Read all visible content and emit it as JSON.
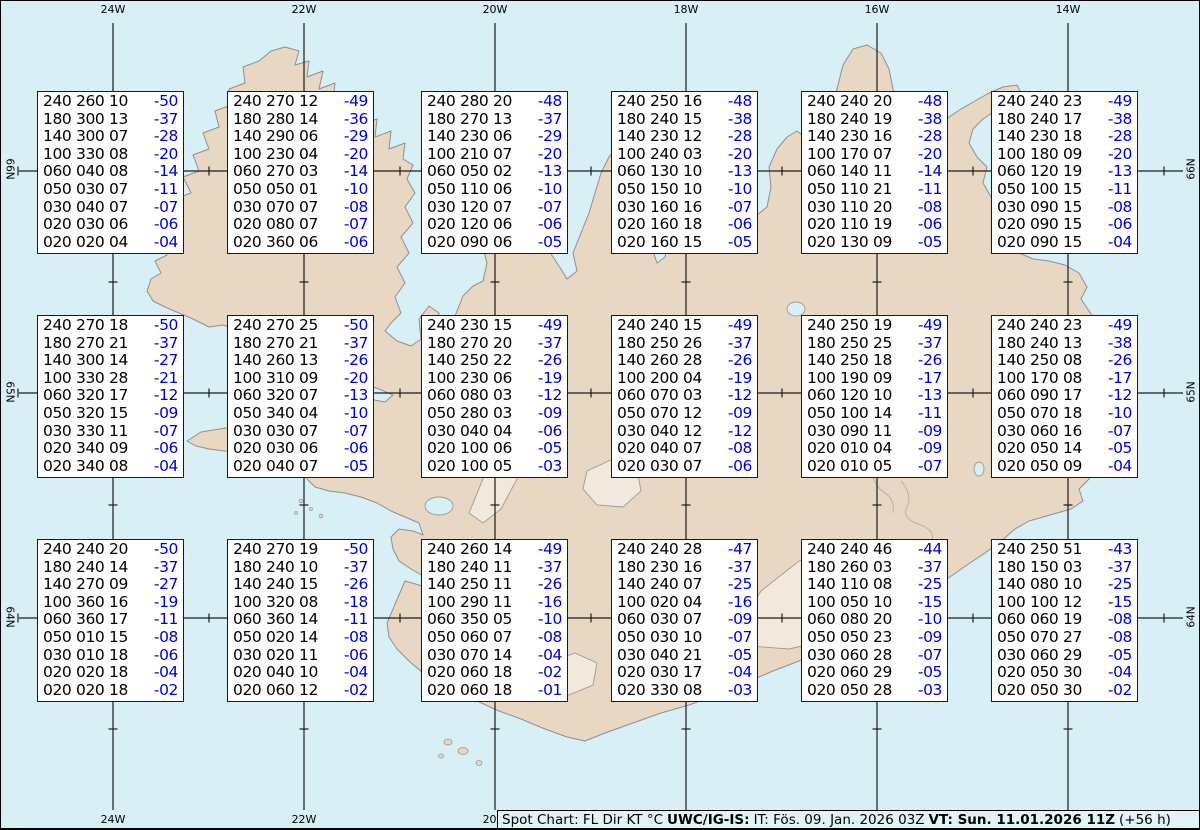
{
  "colors": {
    "ocean": "#d8eff5",
    "land": "#e8d7c2",
    "coastline": "#8f8f8f",
    "graticule": "#1c1c1c",
    "box_background": "#ffffff",
    "value_text": "#000000",
    "temperature_text": "#0000cc",
    "infobar_background": "#e0f5f8"
  },
  "graticule": {
    "top_labels": [
      "24W",
      "22W",
      "20W",
      "18W",
      "16W",
      "14W"
    ],
    "bottom_labels": [
      "24W",
      "22W",
      "20W"
    ],
    "left_labels": [
      "66N",
      "65N",
      "64N"
    ],
    "right_labels": [
      "66N",
      "65N",
      "64N"
    ]
  },
  "status_bar": {
    "title": "Spot Chart: FL Dir KT °C",
    "source": "UWC/IG-IS:",
    "issue": "IT: Fös. 09. Jan. 2026 03Z",
    "valid": "VT: Sun. 11.01.2026 11Z",
    "offset": "(+56 h)"
  },
  "columns": [
    "FL",
    "Dir",
    "KT",
    "°C"
  ],
  "spot_boxes": [
    {
      "rows": [
        [
          "240",
          "260",
          "10",
          "-50"
        ],
        [
          "180",
          "300",
          "13",
          "-37"
        ],
        [
          "140",
          "300",
          "07",
          "-28"
        ],
        [
          "100",
          "330",
          "08",
          "-20"
        ],
        [
          "060",
          "040",
          "08",
          "-14"
        ],
        [
          "050",
          "030",
          "07",
          "-11"
        ],
        [
          "030",
          "040",
          "07",
          "-07"
        ],
        [
          "020",
          "030",
          "06",
          "-06"
        ],
        [
          "020",
          "020",
          "04",
          "-04"
        ]
      ]
    },
    {
      "rows": [
        [
          "240",
          "270",
          "12",
          "-49"
        ],
        [
          "180",
          "280",
          "14",
          "-36"
        ],
        [
          "140",
          "290",
          "06",
          "-29"
        ],
        [
          "100",
          "230",
          "04",
          "-20"
        ],
        [
          "060",
          "270",
          "03",
          "-14"
        ],
        [
          "050",
          "050",
          "01",
          "-10"
        ],
        [
          "030",
          "070",
          "07",
          "-08"
        ],
        [
          "020",
          "080",
          "07",
          "-07"
        ],
        [
          "020",
          "360",
          "06",
          "-06"
        ]
      ]
    },
    {
      "rows": [
        [
          "240",
          "280",
          "20",
          "-48"
        ],
        [
          "180",
          "270",
          "13",
          "-37"
        ],
        [
          "140",
          "230",
          "06",
          "-29"
        ],
        [
          "100",
          "210",
          "07",
          "-20"
        ],
        [
          "060",
          "050",
          "02",
          "-13"
        ],
        [
          "050",
          "110",
          "06",
          "-10"
        ],
        [
          "030",
          "120",
          "07",
          "-07"
        ],
        [
          "020",
          "120",
          "06",
          "-06"
        ],
        [
          "020",
          "090",
          "06",
          "-05"
        ]
      ]
    },
    {
      "rows": [
        [
          "240",
          "250",
          "16",
          "-48"
        ],
        [
          "180",
          "240",
          "15",
          "-38"
        ],
        [
          "140",
          "230",
          "12",
          "-28"
        ],
        [
          "100",
          "240",
          "03",
          "-20"
        ],
        [
          "060",
          "130",
          "10",
          "-13"
        ],
        [
          "050",
          "150",
          "10",
          "-10"
        ],
        [
          "030",
          "160",
          "16",
          "-07"
        ],
        [
          "020",
          "160",
          "18",
          "-06"
        ],
        [
          "020",
          "160",
          "15",
          "-05"
        ]
      ]
    },
    {
      "rows": [
        [
          "240",
          "240",
          "20",
          "-48"
        ],
        [
          "180",
          "240",
          "19",
          "-38"
        ],
        [
          "140",
          "230",
          "16",
          "-28"
        ],
        [
          "100",
          "170",
          "07",
          "-20"
        ],
        [
          "060",
          "140",
          "11",
          "-14"
        ],
        [
          "050",
          "110",
          "21",
          "-11"
        ],
        [
          "030",
          "110",
          "20",
          "-08"
        ],
        [
          "020",
          "110",
          "19",
          "-06"
        ],
        [
          "020",
          "130",
          "09",
          "-05"
        ]
      ]
    },
    {
      "rows": [
        [
          "240",
          "240",
          "23",
          "-49"
        ],
        [
          "180",
          "240",
          "17",
          "-38"
        ],
        [
          "140",
          "230",
          "18",
          "-28"
        ],
        [
          "100",
          "180",
          "09",
          "-20"
        ],
        [
          "060",
          "120",
          "19",
          "-13"
        ],
        [
          "050",
          "100",
          "15",
          "-11"
        ],
        [
          "030",
          "090",
          "15",
          "-08"
        ],
        [
          "020",
          "090",
          "15",
          "-06"
        ],
        [
          "020",
          "090",
          "15",
          "-04"
        ]
      ]
    },
    {
      "rows": [
        [
          "240",
          "270",
          "18",
          "-50"
        ],
        [
          "180",
          "270",
          "21",
          "-37"
        ],
        [
          "140",
          "300",
          "14",
          "-27"
        ],
        [
          "100",
          "330",
          "28",
          "-21"
        ],
        [
          "060",
          "320",
          "17",
          "-12"
        ],
        [
          "050",
          "320",
          "15",
          "-09"
        ],
        [
          "030",
          "330",
          "11",
          "-07"
        ],
        [
          "020",
          "340",
          "09",
          "-06"
        ],
        [
          "020",
          "340",
          "08",
          "-04"
        ]
      ]
    },
    {
      "rows": [
        [
          "240",
          "270",
          "25",
          "-50"
        ],
        [
          "180",
          "270",
          "21",
          "-37"
        ],
        [
          "140",
          "260",
          "13",
          "-26"
        ],
        [
          "100",
          "310",
          "09",
          "-20"
        ],
        [
          "060",
          "320",
          "07",
          "-13"
        ],
        [
          "050",
          "340",
          "04",
          "-10"
        ],
        [
          "030",
          "030",
          "07",
          "-07"
        ],
        [
          "020",
          "030",
          "06",
          "-06"
        ],
        [
          "020",
          "040",
          "07",
          "-05"
        ]
      ]
    },
    {
      "rows": [
        [
          "240",
          "230",
          "15",
          "-49"
        ],
        [
          "180",
          "270",
          "20",
          "-37"
        ],
        [
          "140",
          "250",
          "22",
          "-26"
        ],
        [
          "100",
          "230",
          "06",
          "-19"
        ],
        [
          "060",
          "080",
          "03",
          "-12"
        ],
        [
          "050",
          "280",
          "03",
          "-09"
        ],
        [
          "030",
          "040",
          "04",
          "-06"
        ],
        [
          "020",
          "100",
          "06",
          "-05"
        ],
        [
          "020",
          "100",
          "05",
          "-03"
        ]
      ]
    },
    {
      "rows": [
        [
          "240",
          "240",
          "15",
          "-49"
        ],
        [
          "180",
          "250",
          "26",
          "-37"
        ],
        [
          "140",
          "260",
          "28",
          "-26"
        ],
        [
          "100",
          "200",
          "04",
          "-19"
        ],
        [
          "060",
          "070",
          "03",
          "-12"
        ],
        [
          "050",
          "070",
          "12",
          "-09"
        ],
        [
          "030",
          "040",
          "12",
          "-12"
        ],
        [
          "020",
          "040",
          "07",
          "-08"
        ],
        [
          "020",
          "030",
          "07",
          "-06"
        ]
      ]
    },
    {
      "rows": [
        [
          "240",
          "250",
          "19",
          "-49"
        ],
        [
          "180",
          "250",
          "25",
          "-37"
        ],
        [
          "140",
          "250",
          "18",
          "-26"
        ],
        [
          "100",
          "190",
          "09",
          "-17"
        ],
        [
          "060",
          "120",
          "10",
          "-13"
        ],
        [
          "050",
          "100",
          "14",
          "-11"
        ],
        [
          "030",
          "090",
          "11",
          "-09"
        ],
        [
          "020",
          "010",
          "04",
          "-09"
        ],
        [
          "020",
          "010",
          "05",
          "-07"
        ]
      ]
    },
    {
      "rows": [
        [
          "240",
          "240",
          "23",
          "-49"
        ],
        [
          "180",
          "240",
          "13",
          "-38"
        ],
        [
          "140",
          "250",
          "08",
          "-26"
        ],
        [
          "100",
          "170",
          "08",
          "-17"
        ],
        [
          "060",
          "090",
          "17",
          "-12"
        ],
        [
          "050",
          "070",
          "18",
          "-10"
        ],
        [
          "030",
          "060",
          "16",
          "-07"
        ],
        [
          "020",
          "050",
          "14",
          "-05"
        ],
        [
          "020",
          "050",
          "09",
          "-04"
        ]
      ]
    },
    {
      "rows": [
        [
          "240",
          "240",
          "20",
          "-50"
        ],
        [
          "180",
          "240",
          "14",
          "-37"
        ],
        [
          "140",
          "270",
          "09",
          "-27"
        ],
        [
          "100",
          "360",
          "16",
          "-19"
        ],
        [
          "060",
          "360",
          "17",
          "-11"
        ],
        [
          "050",
          "010",
          "15",
          "-08"
        ],
        [
          "030",
          "010",
          "18",
          "-06"
        ],
        [
          "020",
          "020",
          "18",
          "-04"
        ],
        [
          "020",
          "020",
          "18",
          "-02"
        ]
      ]
    },
    {
      "rows": [
        [
          "240",
          "270",
          "19",
          "-50"
        ],
        [
          "180",
          "240",
          "10",
          "-37"
        ],
        [
          "140",
          "240",
          "15",
          "-26"
        ],
        [
          "100",
          "320",
          "08",
          "-18"
        ],
        [
          "060",
          "360",
          "14",
          "-11"
        ],
        [
          "050",
          "020",
          "14",
          "-08"
        ],
        [
          "030",
          "020",
          "11",
          "-06"
        ],
        [
          "020",
          "040",
          "10",
          "-04"
        ],
        [
          "020",
          "060",
          "12",
          "-02"
        ]
      ]
    },
    {
      "rows": [
        [
          "240",
          "260",
          "14",
          "-49"
        ],
        [
          "180",
          "240",
          "11",
          "-37"
        ],
        [
          "140",
          "250",
          "11",
          "-26"
        ],
        [
          "100",
          "290",
          "11",
          "-16"
        ],
        [
          "060",
          "350",
          "05",
          "-10"
        ],
        [
          "050",
          "060",
          "07",
          "-08"
        ],
        [
          "030",
          "070",
          "14",
          "-04"
        ],
        [
          "020",
          "060",
          "18",
          "-02"
        ],
        [
          "020",
          "060",
          "18",
          "-01"
        ]
      ]
    },
    {
      "rows": [
        [
          "240",
          "240",
          "28",
          "-47"
        ],
        [
          "180",
          "230",
          "16",
          "-37"
        ],
        [
          "140",
          "240",
          "07",
          "-25"
        ],
        [
          "100",
          "020",
          "04",
          "-16"
        ],
        [
          "060",
          "030",
          "07",
          "-09"
        ],
        [
          "050",
          "030",
          "10",
          "-07"
        ],
        [
          "030",
          "040",
          "21",
          "-05"
        ],
        [
          "020",
          "030",
          "17",
          "-04"
        ],
        [
          "020",
          "330",
          "08",
          "-03"
        ]
      ]
    },
    {
      "rows": [
        [
          "240",
          "240",
          "46",
          "-44"
        ],
        [
          "180",
          "260",
          "03",
          "-37"
        ],
        [
          "140",
          "110",
          "08",
          "-25"
        ],
        [
          "100",
          "050",
          "10",
          "-15"
        ],
        [
          "060",
          "080",
          "20",
          "-10"
        ],
        [
          "050",
          "050",
          "23",
          "-09"
        ],
        [
          "030",
          "060",
          "28",
          "-07"
        ],
        [
          "020",
          "060",
          "29",
          "-05"
        ],
        [
          "020",
          "050",
          "28",
          "-03"
        ]
      ]
    },
    {
      "rows": [
        [
          "240",
          "250",
          "51",
          "-43"
        ],
        [
          "180",
          "150",
          "03",
          "-37"
        ],
        [
          "140",
          "080",
          "10",
          "-25"
        ],
        [
          "100",
          "100",
          "12",
          "-15"
        ],
        [
          "060",
          "060",
          "19",
          "-08"
        ],
        [
          "050",
          "070",
          "27",
          "-08"
        ],
        [
          "030",
          "060",
          "29",
          "-05"
        ],
        [
          "020",
          "050",
          "30",
          "-04"
        ],
        [
          "020",
          "050",
          "30",
          "-02"
        ]
      ]
    }
  ]
}
